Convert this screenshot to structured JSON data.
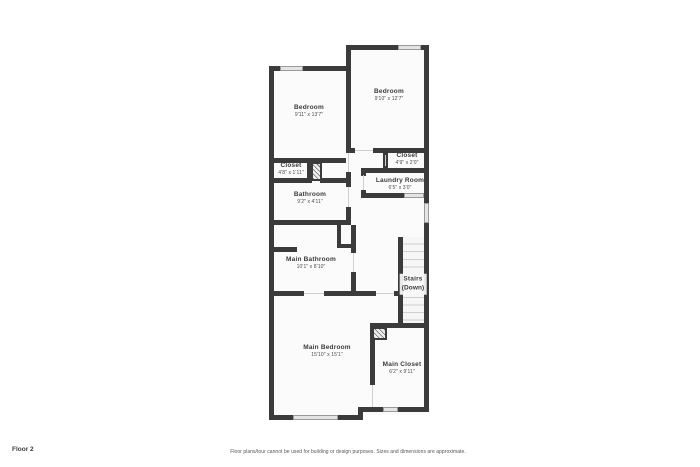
{
  "footer": {
    "floor_label": "Floor 2",
    "disclaimer": "Floor plans/tour cannot be used for building or design purposes. Sizes and dimensions are approximate."
  },
  "rooms": [
    {
      "name": "Bedroom",
      "dims": "9'11\" x 13'7\""
    },
    {
      "name": "Bedroom",
      "dims": "9'10\" x 12'7\""
    },
    {
      "name": "Closet",
      "dims": "4'8\" x 1'11\""
    },
    {
      "name": "Closet",
      "dims": "4'9\" x 2'0\""
    },
    {
      "name": "Laundry Room",
      "dims": "6'5\" x 3'0\""
    },
    {
      "name": "Bathroom",
      "dims": "9'2\" x 4'11\""
    },
    {
      "name": "Main Bathroom",
      "dims": "10'1\" x 8'10\""
    },
    {
      "name": "Stairs",
      "dims": "(Down)"
    },
    {
      "name": "Main Bedroom",
      "dims": "15'10\" x 15'1\""
    },
    {
      "name": "Main Closet",
      "dims": "6'2\" x 9'11\""
    }
  ],
  "colors": {
    "wall": "#3b3b3b",
    "floor": "#fbfbfb",
    "window": "#e4e4e4",
    "window_border": "#9a9a9a",
    "tread": "#cfcfcf",
    "text": "#3b3b3b"
  }
}
